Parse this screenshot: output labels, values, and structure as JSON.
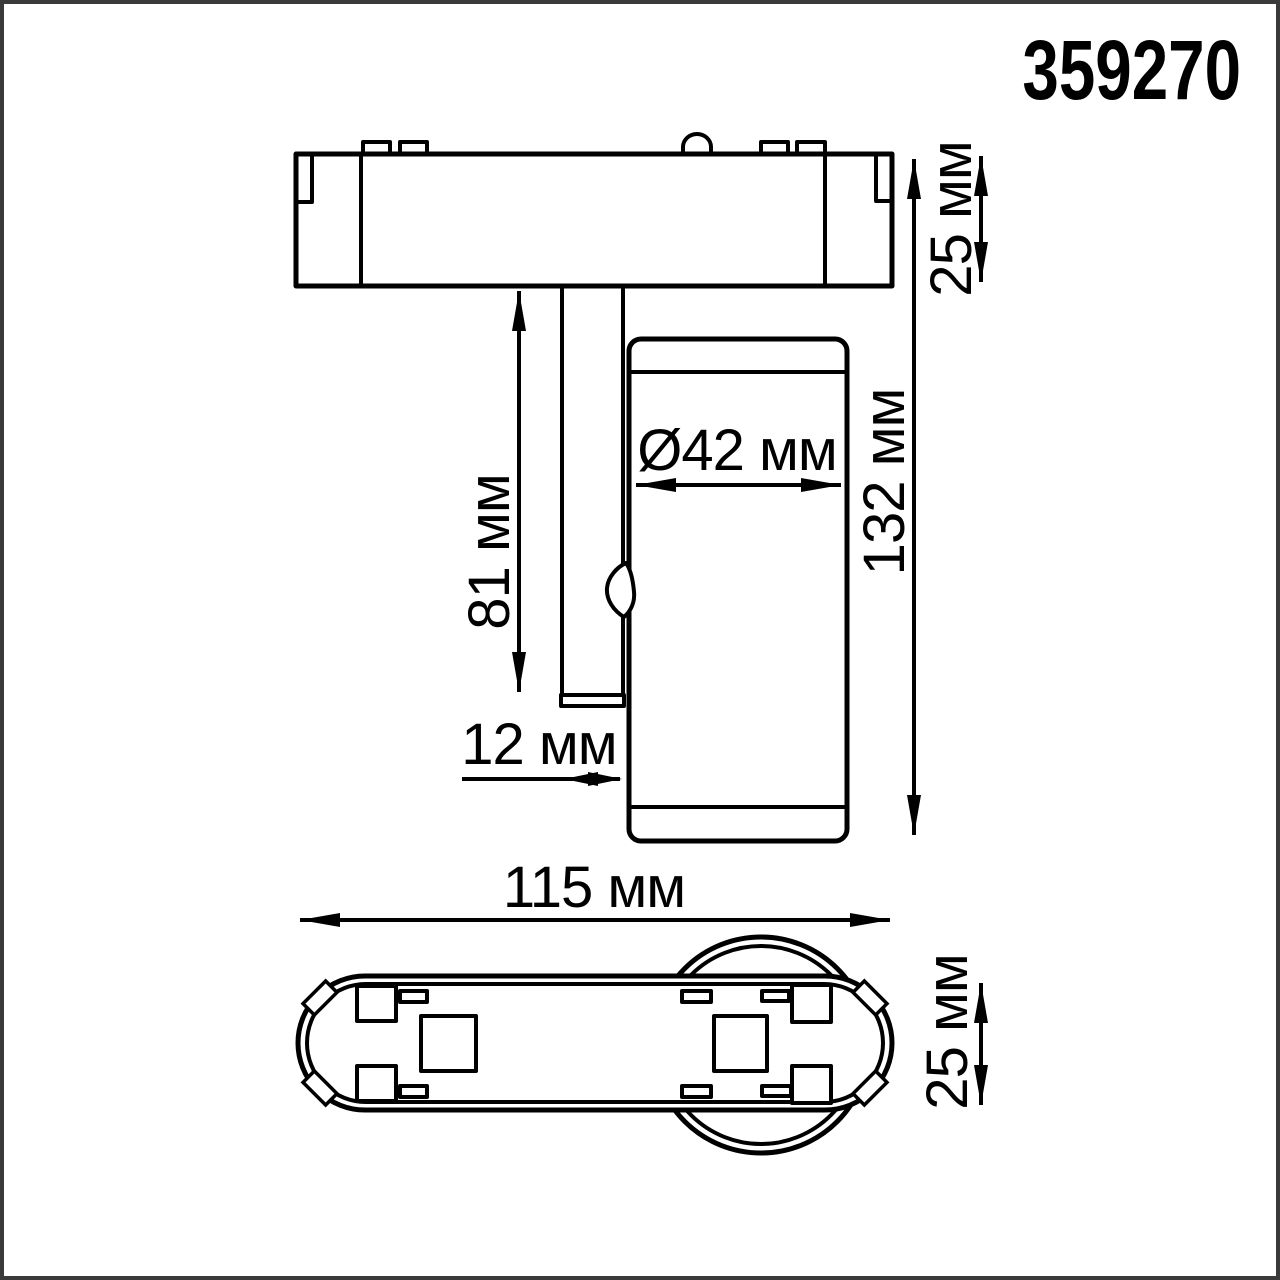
{
  "colors": {
    "background": "#ffffff",
    "line": "#000000",
    "frame": "#3a3a3a"
  },
  "product_number": "359270",
  "side_view": {
    "track_height": "25 мм",
    "stem_length": "81 мм",
    "head_diameter": "Ø42 мм",
    "total_height": "132 мм",
    "stem_thickness": "12 мм"
  },
  "bottom_view": {
    "base_length": "115 мм",
    "base_width": "25 мм"
  }
}
